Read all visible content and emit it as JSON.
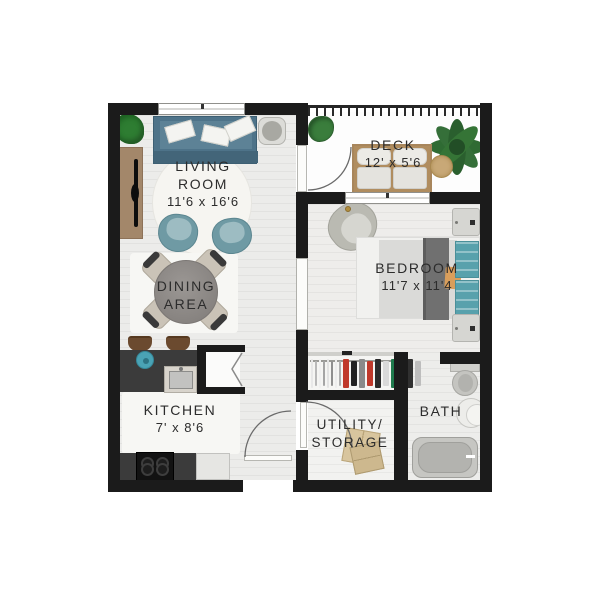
{
  "rooms": {
    "living": {
      "line1": "LIVING",
      "line2": "ROOM",
      "dims": "11'6 x 16'6"
    },
    "dining": {
      "line1": "DINING",
      "line2": "AREA"
    },
    "kitchen": {
      "name": "KITCHEN",
      "dims": "7' x 8'6"
    },
    "deck": {
      "name": "DECK",
      "dims": "12' x 5'6"
    },
    "bedroom": {
      "name": "BEDROOM",
      "dims": "11'7 x 11'4"
    },
    "utility": {
      "line1": "UTILITY/",
      "line2": "STORAGE"
    },
    "bath": {
      "name": "BATH"
    }
  },
  "colors": {
    "wall": "#1b1b1b",
    "floor": "#ececea",
    "sofa_blue": "#4e7389",
    "accent_chair_teal": "#6f9aa4",
    "bed_pillow_teal": "#58a1ac",
    "wood": "#a3876a",
    "deck_sofa_wood": "#a8865c",
    "counter_charcoal": "#3b3b3b",
    "plant_green": "#2f6b33",
    "box_tan": "#d8c59e",
    "text": "#2c2c2c"
  },
  "closet": {
    "clothes_colors": [
      "#e8e8e8",
      "#b9b9b9",
      "#f0f0f0",
      "#a5a5a5",
      "#e3e3e3",
      "#8f8f8f",
      "#ededed",
      "#b0b0b0",
      "#c0392b",
      "#222222",
      "#8a8a8a",
      "#c0392b",
      "#2b2b2b",
      "#d9d9d9",
      "#1f7a4d",
      "#c0392b",
      "#303030",
      "#bdbdbd"
    ]
  },
  "furniture": {
    "living_room": [
      "sofa",
      "throw-pillows",
      "media-console",
      "tv",
      "floor-plant",
      "side-stool",
      "accent-chair-left",
      "accent-chair-right",
      "area-rug"
    ],
    "dining_area": [
      "round-table",
      "dining-chairs"
    ],
    "kitchen": [
      "island-counter",
      "sink",
      "teal-bowl",
      "bar-stools",
      "cooktop",
      "refrigerator",
      "bifold-closet"
    ],
    "deck": [
      "outdoor-sofa",
      "round-pouf",
      "potted-plant-small",
      "potted-plant-large",
      "railing"
    ],
    "bedroom": [
      "bed",
      "teal-pillows",
      "tan-pillow",
      "nightstand-top",
      "nightstand-bottom",
      "armchair",
      "reach-in-closet"
    ],
    "utility": [
      "storage-boxes",
      "door"
    ],
    "bath": [
      "toilet",
      "round-sink",
      "bathtub"
    ]
  }
}
